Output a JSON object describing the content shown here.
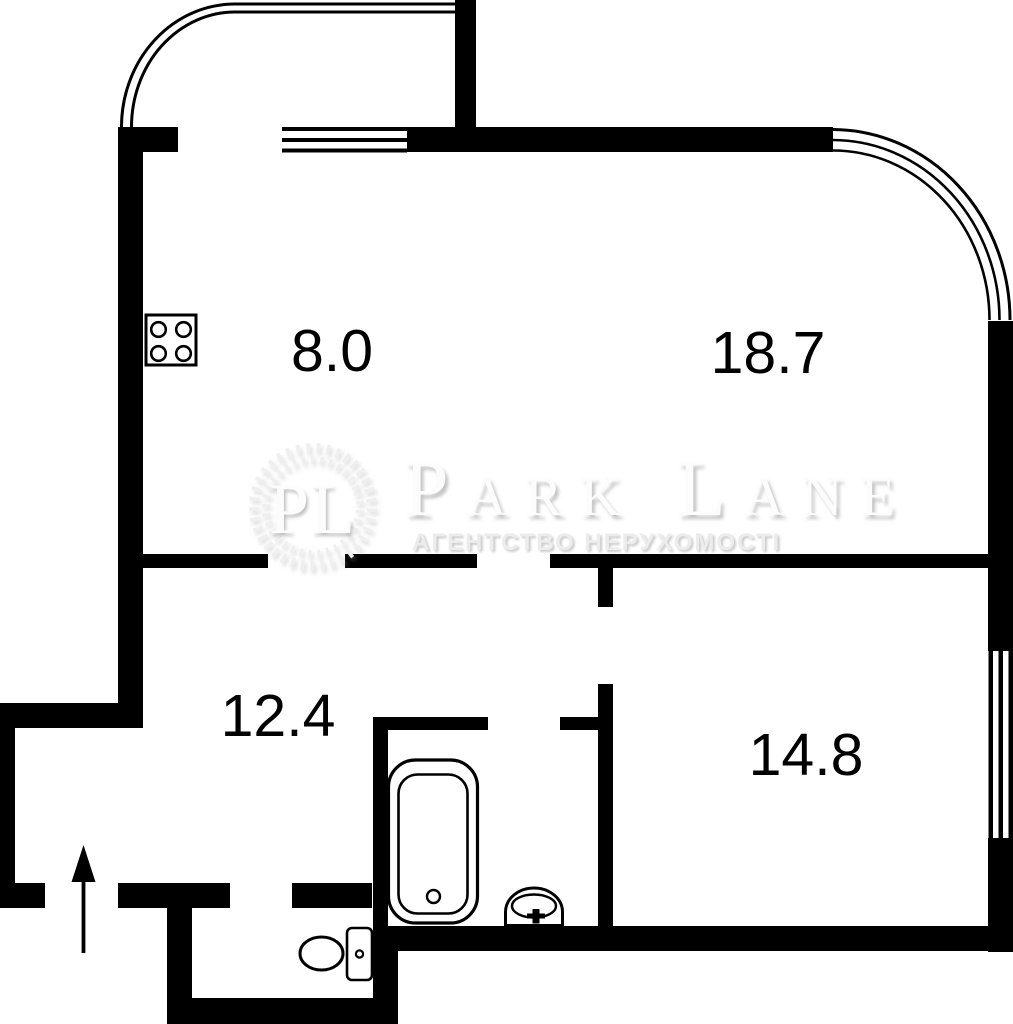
{
  "plan": {
    "type": "apartment-floor-plan",
    "rooms": [
      {
        "name": "kitchen",
        "area_label": "8.0"
      },
      {
        "name": "living-room",
        "area_label": "18.7"
      },
      {
        "name": "hallway",
        "area_label": "12.4"
      },
      {
        "name": "bedroom",
        "area_label": "14.8"
      }
    ]
  },
  "watermark": {
    "monogram": "PL",
    "title": "Park Lane",
    "subtitle": "АГЕНТСТВО НЕРУХОМОСТІ"
  },
  "icons": {
    "stove": "stove-icon",
    "bathtub": "bathtub-icon",
    "sink": "sink-icon",
    "toilet": "toilet-icon",
    "entrance": "entrance-arrow-icon"
  },
  "colors": {
    "wall": "#000000",
    "background": "#ffffff",
    "watermark_text": "#fcfcfc",
    "watermark_subtitle": "#ececec",
    "label_text": "#000000"
  }
}
